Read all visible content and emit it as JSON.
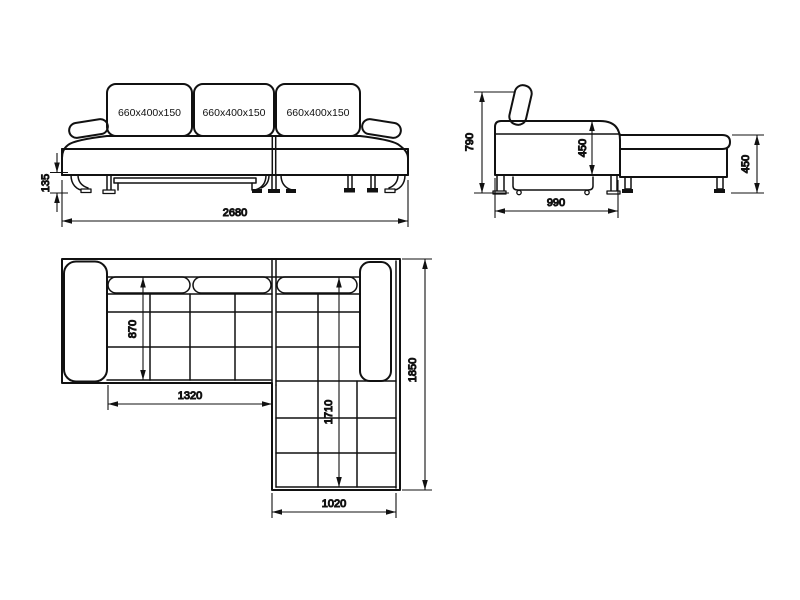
{
  "views": {
    "front": {
      "cushions": [
        {
          "label": "660x400x150"
        },
        {
          "label": "660x400x150"
        },
        {
          "label": "660x400x150"
        }
      ],
      "dims": {
        "leg_height": "135",
        "overall_width": "2680"
      }
    },
    "side": {
      "dims": {
        "overall_height": "790",
        "seat_height": "450",
        "seat_depth": "990",
        "chaise_height": "450"
      }
    },
    "plan": {
      "dims": {
        "seat_depth": "870",
        "left_section_width": "1320",
        "chaise_length": "1710",
        "overall_depth": "1850",
        "chaise_width": "1020"
      }
    }
  },
  "colors": {
    "line": "#111111",
    "background": "#ffffff"
  }
}
